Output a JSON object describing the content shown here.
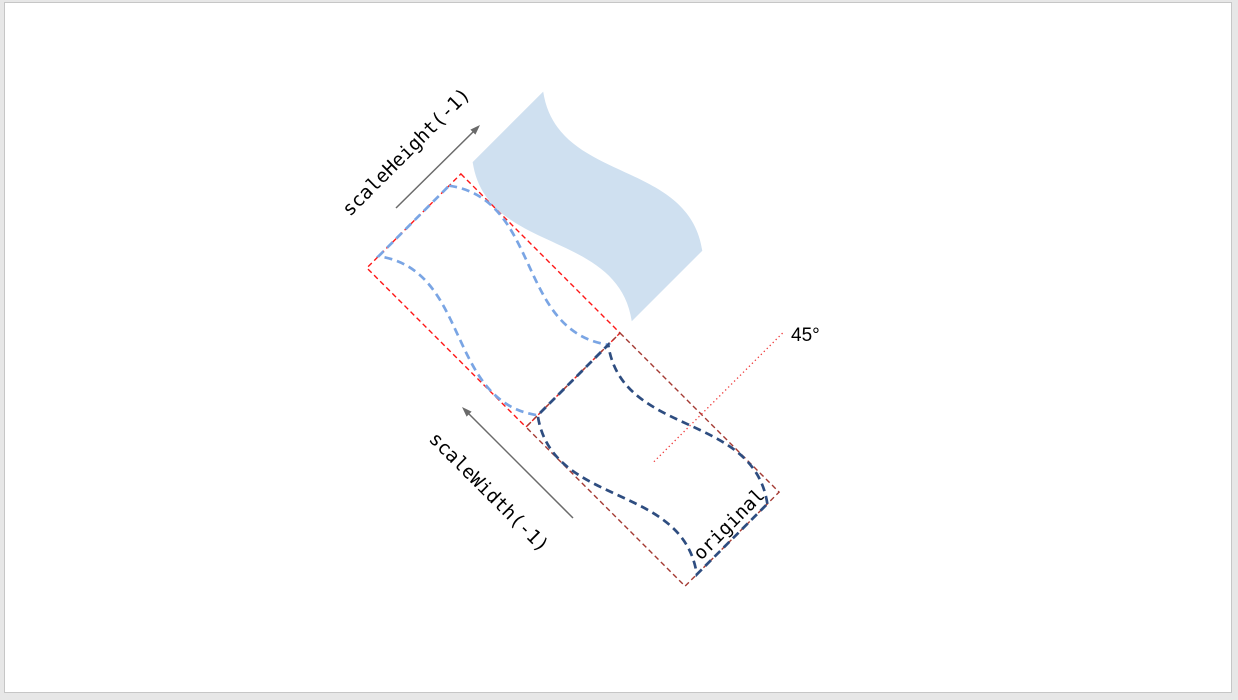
{
  "canvas": {
    "background": "#e7e7e7",
    "slide_fill": "#ffffff",
    "slide_border": "#c6c6c6"
  },
  "figure": {
    "labels": {
      "scale_height": "scaleHeight(-1)",
      "scale_width": "scaleWidth(-1)",
      "original": "original",
      "angle": "45°"
    },
    "colors": {
      "wave_fill": "#cfe0f0",
      "flipped_outline": "#7aa5e4",
      "original_outline": "#2e4d80",
      "flipped_bbox": "#fe1616",
      "original_bbox": "#a43a33",
      "angle_line": "#ee3939",
      "arrow": "#6a6a6a",
      "label_text": "#000000"
    },
    "geometry": {
      "rotation_deg": 45,
      "box_width": 225,
      "box_height": 133
    }
  }
}
